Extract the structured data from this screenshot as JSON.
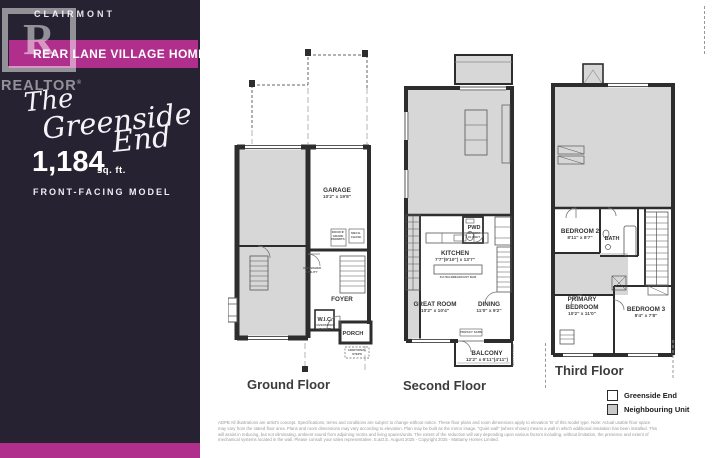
{
  "palette": {
    "sidebar_bg": "#262231",
    "accent_magenta": "#b02e8c",
    "neighbour_gray": "#d7d7d7",
    "wall": "#2d2d2d"
  },
  "sidebar": {
    "community": "CLAIRMONT",
    "banner": "REAR LANE VILLAGE HOMES",
    "script_line1": "The",
    "script_line2": "Greenside",
    "script_line3": "End",
    "sqft": "1,184",
    "sqft_unit": "sq. ft.",
    "model_type": "FRONT-FACING MODEL",
    "realtor_r": "R",
    "realtor_word": "REALTOR",
    "registered": "®"
  },
  "floors": {
    "ground": {
      "label": "Ground Floor",
      "garage_name": "GARAGE",
      "garage_dims": "10'2\" x 19'8\"",
      "foyer": "FOYER",
      "wic": "W.I.C.",
      "wic_note1": "OVERSIZED",
      "wic_note2": "CLOSET",
      "porch": "PORCH",
      "note_door1": "DOOR IF",
      "note_door2": "GRADE",
      "note_door3": "PERMITS",
      "note_mech1": "MECH.",
      "note_mech2": "CHASE",
      "note_util1": "UNFINISHED",
      "note_util2": "UTILITY",
      "note_steps1": "ADDITIONAL",
      "note_steps2": "STEPS"
    },
    "second": {
      "label": "Second Floor",
      "pwd": "PWD",
      "pwd_note1": "BROOM",
      "pwd_note2": "CLOSET",
      "kitchen_name": "KITCHEN",
      "kitchen_dims": "7'7\"(9'10\") x 13'7\"",
      "island_note": "FLUSH BREAKFAST BAR",
      "great_name": "GREAT ROOM",
      "great_dims": "10'2\" x 10'4\"",
      "dining_name": "DINING",
      "dining_dims": "11'0\" x 9'2\"",
      "balcony_name": "BALCONY",
      "balcony_dims": "12'2\" x 6'11\"(4'11\")",
      "privacy_box": "PRIVACY SCRN",
      "privacy_vert": "PRIVACY SCRN"
    },
    "third": {
      "label": "Third Floor",
      "bed2_name": "BEDROOM 2",
      "bed2_dims": "8'11\" x 8'7\"",
      "bath": "BATH",
      "primary_1": "PRIMARY",
      "primary_2": "BEDROOM",
      "primary_dims": "10'2\" x 11'0\"",
      "bed3_name": "BEDROOM 3",
      "bed3_dims": "8'4\" x 7'8\""
    }
  },
  "legend": {
    "greenside": "Greenside End",
    "greenside_swatch": "#ffffff",
    "neighbour": "Neighbouring Unit",
    "neighbour_swatch": "#c9c9c9"
  },
  "disclaimer": {
    "line1": "ADPB All illustrations are artist's concept. Specifications, terms and conditions are subject to change without notice. These floor plans and room dimensions apply to elevation 'B' of this model type. Note: Actual usable floor space",
    "line2": "may vary from the stated floor area. Plans and room dimensions may vary according to elevation. Plan may be built as the mirror image. \"Quiet wall\" (where shown) means a wall in which additional insulation has been installed. This",
    "line3": "will assist in reducing, but not eliminating, ambient sound from adjoining rooms and living spaces/units. The extent of the reduction will vary depending upon various factors including, without limitation, the presence and extent of",
    "line4": "mechanical systems located in the wall. Please consult your sales representative. E.&O.E. August 2025 - Copyright 2025 - Mattamy Homes Limited."
  }
}
